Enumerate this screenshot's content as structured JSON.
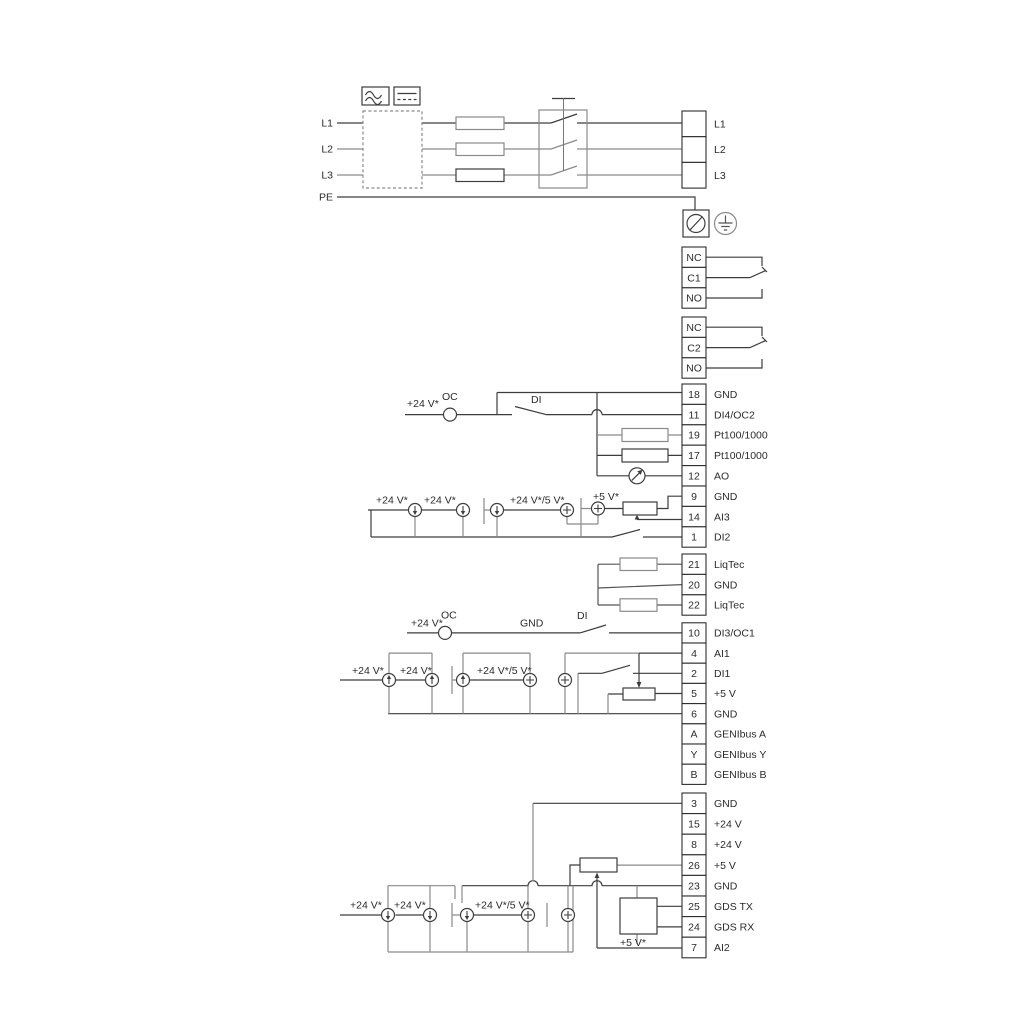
{
  "power": {
    "inputs": [
      "L1",
      "L2",
      "L3",
      "PE"
    ],
    "outputs": [
      "L1",
      "L2",
      "L3"
    ]
  },
  "relays": [
    [
      "NC",
      "C1",
      "NO"
    ],
    [
      "NC",
      "C2",
      "NO"
    ]
  ],
  "blocks": {
    "io1": [
      {
        "id": "18",
        "label": "GND"
      },
      {
        "id": "11",
        "label": "DI4/OC2"
      },
      {
        "id": "19",
        "label": "Pt100/1000"
      },
      {
        "id": "17",
        "label": "Pt100/1000"
      },
      {
        "id": "12",
        "label": "AO"
      },
      {
        "id": "9",
        "label": "GND"
      },
      {
        "id": "14",
        "label": "AI3"
      },
      {
        "id": "1",
        "label": "DI2"
      }
    ],
    "liqtec": [
      {
        "id": "21",
        "label": "LiqTec"
      },
      {
        "id": "20",
        "label": "GND"
      },
      {
        "id": "22",
        "label": "LiqTec"
      }
    ],
    "io2": [
      {
        "id": "10",
        "label": "DI3/OC1"
      },
      {
        "id": "4",
        "label": "AI1"
      },
      {
        "id": "2",
        "label": "DI1"
      },
      {
        "id": "5",
        "label": "+5 V"
      },
      {
        "id": "6",
        "label": "GND"
      },
      {
        "id": "A",
        "label": "GENIbus A"
      },
      {
        "id": "Y",
        "label": "GENIbus Y"
      },
      {
        "id": "B",
        "label": "GENIbus B"
      }
    ],
    "io3": [
      {
        "id": "3",
        "label": "GND"
      },
      {
        "id": "15",
        "label": "+24 V"
      },
      {
        "id": "8",
        "label": "+24 V"
      },
      {
        "id": "26",
        "label": "+5 V"
      },
      {
        "id": "23",
        "label": "GND"
      },
      {
        "id": "25",
        "label": "GDS TX"
      },
      {
        "id": "24",
        "label": "GDS RX"
      },
      {
        "id": "7",
        "label": "AI2"
      }
    ]
  },
  "ann": {
    "v24": "+24 V*",
    "v24or5": "+24 V*/5 V*",
    "v5": "+5 V*",
    "oc": "OC",
    "di": "DI",
    "gnd": "GND"
  },
  "colors": {
    "ink": "#3d3d3d",
    "mid": "#555555",
    "gray": "#8a8a8a"
  }
}
